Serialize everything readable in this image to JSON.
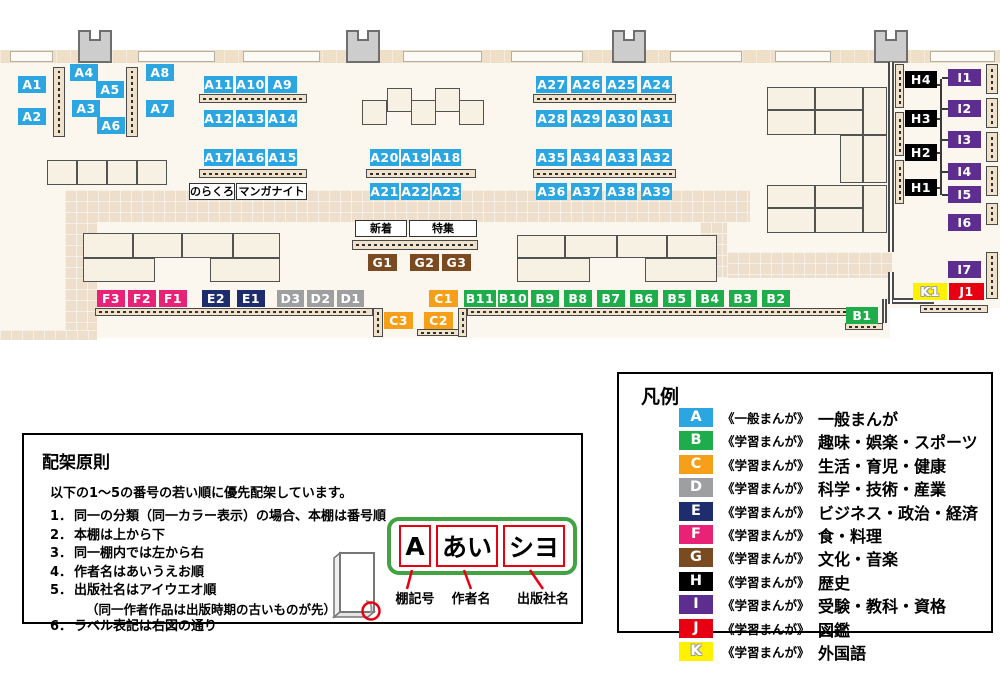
{
  "colors": {
    "A": "#2CA6E0",
    "B": "#1FAD4B",
    "C": "#F6A01A",
    "D": "#9E9FA0",
    "E": "#1E2D6D",
    "F": "#E82277",
    "G": "#7A4A21",
    "H": "#000000",
    "I": "#5D2D90",
    "J": "#E60012",
    "K": "#FFF100"
  },
  "map": {
    "labels": [
      {
        "t": "A1",
        "c": "A",
        "x": 18,
        "y": 76,
        "w": 28
      },
      {
        "t": "A2",
        "c": "A",
        "x": 18,
        "y": 108,
        "w": 28
      },
      {
        "t": "A4",
        "c": "A",
        "x": 70,
        "y": 64,
        "w": 28
      },
      {
        "t": "A5",
        "c": "A",
        "x": 96,
        "y": 81,
        "w": 28
      },
      {
        "t": "A3",
        "c": "A",
        "x": 72,
        "y": 100,
        "w": 28
      },
      {
        "t": "A6",
        "c": "A",
        "x": 97,
        "y": 117,
        "w": 28
      },
      {
        "t": "A8",
        "c": "A",
        "x": 146,
        "y": 64,
        "w": 28
      },
      {
        "t": "A7",
        "c": "A",
        "x": 146,
        "y": 100,
        "w": 28
      },
      {
        "t": "A11",
        "c": "A",
        "x": 204,
        "y": 76,
        "w": 29
      },
      {
        "t": "A10",
        "c": "A",
        "x": 236,
        "y": 76,
        "w": 29
      },
      {
        "t": "A9",
        "c": "A",
        "x": 268,
        "y": 76,
        "w": 29
      },
      {
        "t": "A12",
        "c": "A",
        "x": 204,
        "y": 110,
        "w": 29
      },
      {
        "t": "A13",
        "c": "A",
        "x": 236,
        "y": 110,
        "w": 29
      },
      {
        "t": "A14",
        "c": "A",
        "x": 268,
        "y": 110,
        "w": 29
      },
      {
        "t": "A17",
        "c": "A",
        "x": 204,
        "y": 149,
        "w": 29
      },
      {
        "t": "A16",
        "c": "A",
        "x": 236,
        "y": 149,
        "w": 29
      },
      {
        "t": "A15",
        "c": "A",
        "x": 268,
        "y": 149,
        "w": 29
      },
      {
        "t": "A20",
        "c": "A",
        "x": 370,
        "y": 149,
        "w": 29
      },
      {
        "t": "A19",
        "c": "A",
        "x": 401,
        "y": 149,
        "w": 29
      },
      {
        "t": "A18",
        "c": "A",
        "x": 432,
        "y": 149,
        "w": 29
      },
      {
        "t": "A21",
        "c": "A",
        "x": 370,
        "y": 183,
        "w": 29
      },
      {
        "t": "A22",
        "c": "A",
        "x": 401,
        "y": 183,
        "w": 29
      },
      {
        "t": "A23",
        "c": "A",
        "x": 432,
        "y": 183,
        "w": 29
      },
      {
        "t": "A27",
        "c": "A",
        "x": 536,
        "y": 76,
        "w": 31
      },
      {
        "t": "A26",
        "c": "A",
        "x": 571,
        "y": 76,
        "w": 31
      },
      {
        "t": "A25",
        "c": "A",
        "x": 606,
        "y": 76,
        "w": 31
      },
      {
        "t": "A24",
        "c": "A",
        "x": 641,
        "y": 76,
        "w": 31
      },
      {
        "t": "A28",
        "c": "A",
        "x": 536,
        "y": 110,
        "w": 31
      },
      {
        "t": "A29",
        "c": "A",
        "x": 571,
        "y": 110,
        "w": 31
      },
      {
        "t": "A30",
        "c": "A",
        "x": 606,
        "y": 110,
        "w": 31
      },
      {
        "t": "A31",
        "c": "A",
        "x": 641,
        "y": 110,
        "w": 31
      },
      {
        "t": "A35",
        "c": "A",
        "x": 536,
        "y": 149,
        "w": 31
      },
      {
        "t": "A34",
        "c": "A",
        "x": 571,
        "y": 149,
        "w": 31
      },
      {
        "t": "A33",
        "c": "A",
        "x": 606,
        "y": 149,
        "w": 31
      },
      {
        "t": "A32",
        "c": "A",
        "x": 641,
        "y": 149,
        "w": 31
      },
      {
        "t": "A36",
        "c": "A",
        "x": 536,
        "y": 183,
        "w": 31
      },
      {
        "t": "A37",
        "c": "A",
        "x": 571,
        "y": 183,
        "w": 31
      },
      {
        "t": "A38",
        "c": "A",
        "x": 606,
        "y": 183,
        "w": 31
      },
      {
        "t": "A39",
        "c": "A",
        "x": 641,
        "y": 183,
        "w": 31
      },
      {
        "t": "F3",
        "c": "F",
        "x": 97,
        "y": 290,
        "w": 28
      },
      {
        "t": "F2",
        "c": "F",
        "x": 128,
        "y": 290,
        "w": 28
      },
      {
        "t": "F1",
        "c": "F",
        "x": 159,
        "y": 290,
        "w": 28
      },
      {
        "t": "E2",
        "c": "E",
        "x": 202,
        "y": 290,
        "w": 28
      },
      {
        "t": "E1",
        "c": "E",
        "x": 237,
        "y": 290,
        "w": 28
      },
      {
        "t": "D3",
        "c": "D",
        "x": 277,
        "y": 290,
        "w": 27
      },
      {
        "t": "D2",
        "c": "D",
        "x": 307,
        "y": 290,
        "w": 27
      },
      {
        "t": "D1",
        "c": "D",
        "x": 337,
        "y": 290,
        "w": 27
      },
      {
        "t": "C1",
        "c": "C",
        "x": 429,
        "y": 290,
        "w": 29
      },
      {
        "t": "C3",
        "c": "C",
        "x": 384,
        "y": 312,
        "w": 29
      },
      {
        "t": "C2",
        "c": "C",
        "x": 424,
        "y": 312,
        "w": 29
      },
      {
        "t": "G1",
        "c": "G",
        "x": 368,
        "y": 254,
        "w": 29
      },
      {
        "t": "G2",
        "c": "G",
        "x": 410,
        "y": 254,
        "w": 29
      },
      {
        "t": "G3",
        "c": "G",
        "x": 442,
        "y": 254,
        "w": 29
      },
      {
        "t": "B11",
        "c": "B",
        "x": 464,
        "y": 290,
        "w": 32
      },
      {
        "t": "B10",
        "c": "B",
        "x": 498,
        "y": 290,
        "w": 30
      },
      {
        "t": "B9",
        "c": "B",
        "x": 531,
        "y": 290,
        "w": 28
      },
      {
        "t": "B8",
        "c": "B",
        "x": 564,
        "y": 290,
        "w": 28
      },
      {
        "t": "B7",
        "c": "B",
        "x": 597,
        "y": 290,
        "w": 28
      },
      {
        "t": "B6",
        "c": "B",
        "x": 630,
        "y": 290,
        "w": 28
      },
      {
        "t": "B5",
        "c": "B",
        "x": 663,
        "y": 290,
        "w": 28
      },
      {
        "t": "B4",
        "c": "B",
        "x": 696,
        "y": 290,
        "w": 28
      },
      {
        "t": "B3",
        "c": "B",
        "x": 729,
        "y": 290,
        "w": 28
      },
      {
        "t": "B2",
        "c": "B",
        "x": 762,
        "y": 290,
        "w": 28
      },
      {
        "t": "B1",
        "c": "B",
        "x": 846,
        "y": 307,
        "w": 32
      },
      {
        "t": "H4",
        "c": "H",
        "x": 905,
        "y": 71,
        "w": 32
      },
      {
        "t": "H3",
        "c": "H",
        "x": 905,
        "y": 110,
        "w": 32
      },
      {
        "t": "H2",
        "c": "H",
        "x": 905,
        "y": 144,
        "w": 32
      },
      {
        "t": "H1",
        "c": "H",
        "x": 905,
        "y": 179,
        "w": 32
      },
      {
        "t": "I1",
        "c": "I",
        "x": 948,
        "y": 69,
        "w": 33
      },
      {
        "t": "I2",
        "c": "I",
        "x": 948,
        "y": 100,
        "w": 33
      },
      {
        "t": "I3",
        "c": "I",
        "x": 948,
        "y": 131,
        "w": 33
      },
      {
        "t": "I4",
        "c": "I",
        "x": 948,
        "y": 163,
        "w": 33
      },
      {
        "t": "I5",
        "c": "I",
        "x": 948,
        "y": 186,
        "w": 33
      },
      {
        "t": "I6",
        "c": "I",
        "x": 948,
        "y": 214,
        "w": 33
      },
      {
        "t": "I7",
        "c": "I",
        "x": 948,
        "y": 261,
        "w": 33
      },
      {
        "t": "K1",
        "c": "K",
        "x": 913,
        "y": 283,
        "w": 34
      },
      {
        "t": "J1",
        "c": "J",
        "x": 949,
        "y": 283,
        "w": 35
      }
    ],
    "callouts": [
      {
        "t": "のらくろ",
        "x": 189,
        "y": 183,
        "w": 46
      },
      {
        "t": "マンガナイト",
        "x": 236,
        "y": 183,
        "w": 71
      },
      {
        "t": "新着",
        "x": 355,
        "y": 220,
        "w": 52
      },
      {
        "t": "特集",
        "x": 409,
        "y": 220,
        "w": 68
      }
    ]
  },
  "legend": {
    "title": "凡例",
    "entries": [
      {
        "code": "A",
        "type": "《一般まんが》",
        "label": "一般まんが"
      },
      {
        "code": "B",
        "type": "《学習まんが》",
        "label": "趣味・娯楽・スポーツ"
      },
      {
        "code": "C",
        "type": "《学習まんが》",
        "label": "生活・育児・健康"
      },
      {
        "code": "D",
        "type": "《学習まんが》",
        "label": "科学・技術・産業"
      },
      {
        "code": "E",
        "type": "《学習まんが》",
        "label": "ビジネス・政治・経済"
      },
      {
        "code": "F",
        "type": "《学習まんが》",
        "label": "食・料理"
      },
      {
        "code": "G",
        "type": "《学習まんが》",
        "label": "文化・音楽"
      },
      {
        "code": "H",
        "type": "《学習まんが》",
        "label": "歴史"
      },
      {
        "code": "I",
        "type": "《学習まんが》",
        "label": "受験・教科・資格"
      },
      {
        "code": "J",
        "type": "《学習まんが》",
        "label": "図鑑"
      },
      {
        "code": "K",
        "type": "《学習まんが》",
        "label": "外国語"
      }
    ]
  },
  "principles": {
    "title": "配架原則",
    "intro": "以下の1～5の番号の若い順に優先配架しています。",
    "items": [
      {
        "no": "1．",
        "text": "同一の分類（同一カラー表示）の場合、本棚は番号順"
      },
      {
        "no": "2．",
        "text": "本棚は上から下"
      },
      {
        "no": "3．",
        "text": "同一棚内では左から右"
      },
      {
        "no": "4．",
        "text": "作者名はあいうえお順"
      },
      {
        "no": "5．",
        "text": "出版社名はアイウエオ順",
        "note": "（同一作者作品は出版時期の古いものが先）"
      },
      {
        "no": "6．",
        "text": "ラベル表記は右図の通り"
      }
    ]
  },
  "label_diagram": {
    "segments": [
      "A",
      "あい",
      "シヨ"
    ],
    "captions": [
      "棚記号",
      "作者名",
      "出版社名"
    ]
  }
}
